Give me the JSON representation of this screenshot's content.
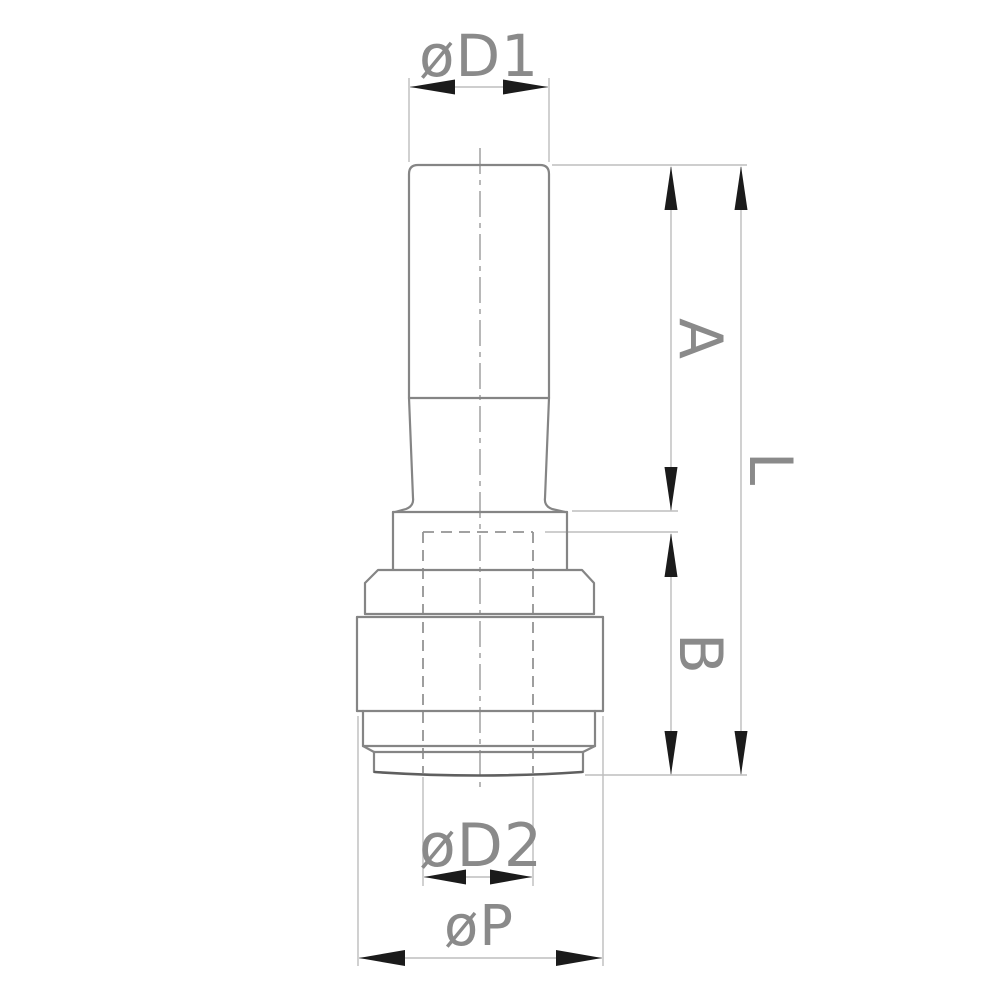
{
  "diagram": {
    "kind": "technical-drawing",
    "subject": "push-fit-reducer-fitting-side-view",
    "background": "#ffffff",
    "colors": {
      "part_outline": "#858585",
      "heavy_edge": "#5f5f5f",
      "dimension_lines": "#bdbdbd",
      "hidden_lines": "#949494",
      "centerline": "#9a9a9a",
      "arrowheads": "#1b1b1b",
      "label_text": "#8a8a8a"
    },
    "labels": {
      "diameter_d1": "øD1",
      "length_a": "A",
      "length_l": "L",
      "length_b": "B",
      "diameter_d2": "øD2",
      "diameter_p": "øP"
    },
    "dimensions": [
      {
        "id": "d1",
        "label": "øD1",
        "orientation": "horizontal",
        "measures": "stem tube outer diameter",
        "position": "top"
      },
      {
        "id": "a",
        "label": "A",
        "orientation": "vertical",
        "measures": "stem length from tube top to collar",
        "position": "right-inner"
      },
      {
        "id": "b",
        "label": "B",
        "orientation": "vertical",
        "measures": "body length from bore stop to bottom face",
        "position": "right-inner"
      },
      {
        "id": "l",
        "label": "L",
        "orientation": "vertical",
        "measures": "overall length",
        "position": "right-outer"
      },
      {
        "id": "d2",
        "label": "øD2",
        "orientation": "horizontal",
        "measures": "hidden bore diameter",
        "position": "bottom"
      },
      {
        "id": "p",
        "label": "øP",
        "orientation": "horizontal",
        "measures": "body outer diameter",
        "position": "bottom"
      }
    ]
  }
}
